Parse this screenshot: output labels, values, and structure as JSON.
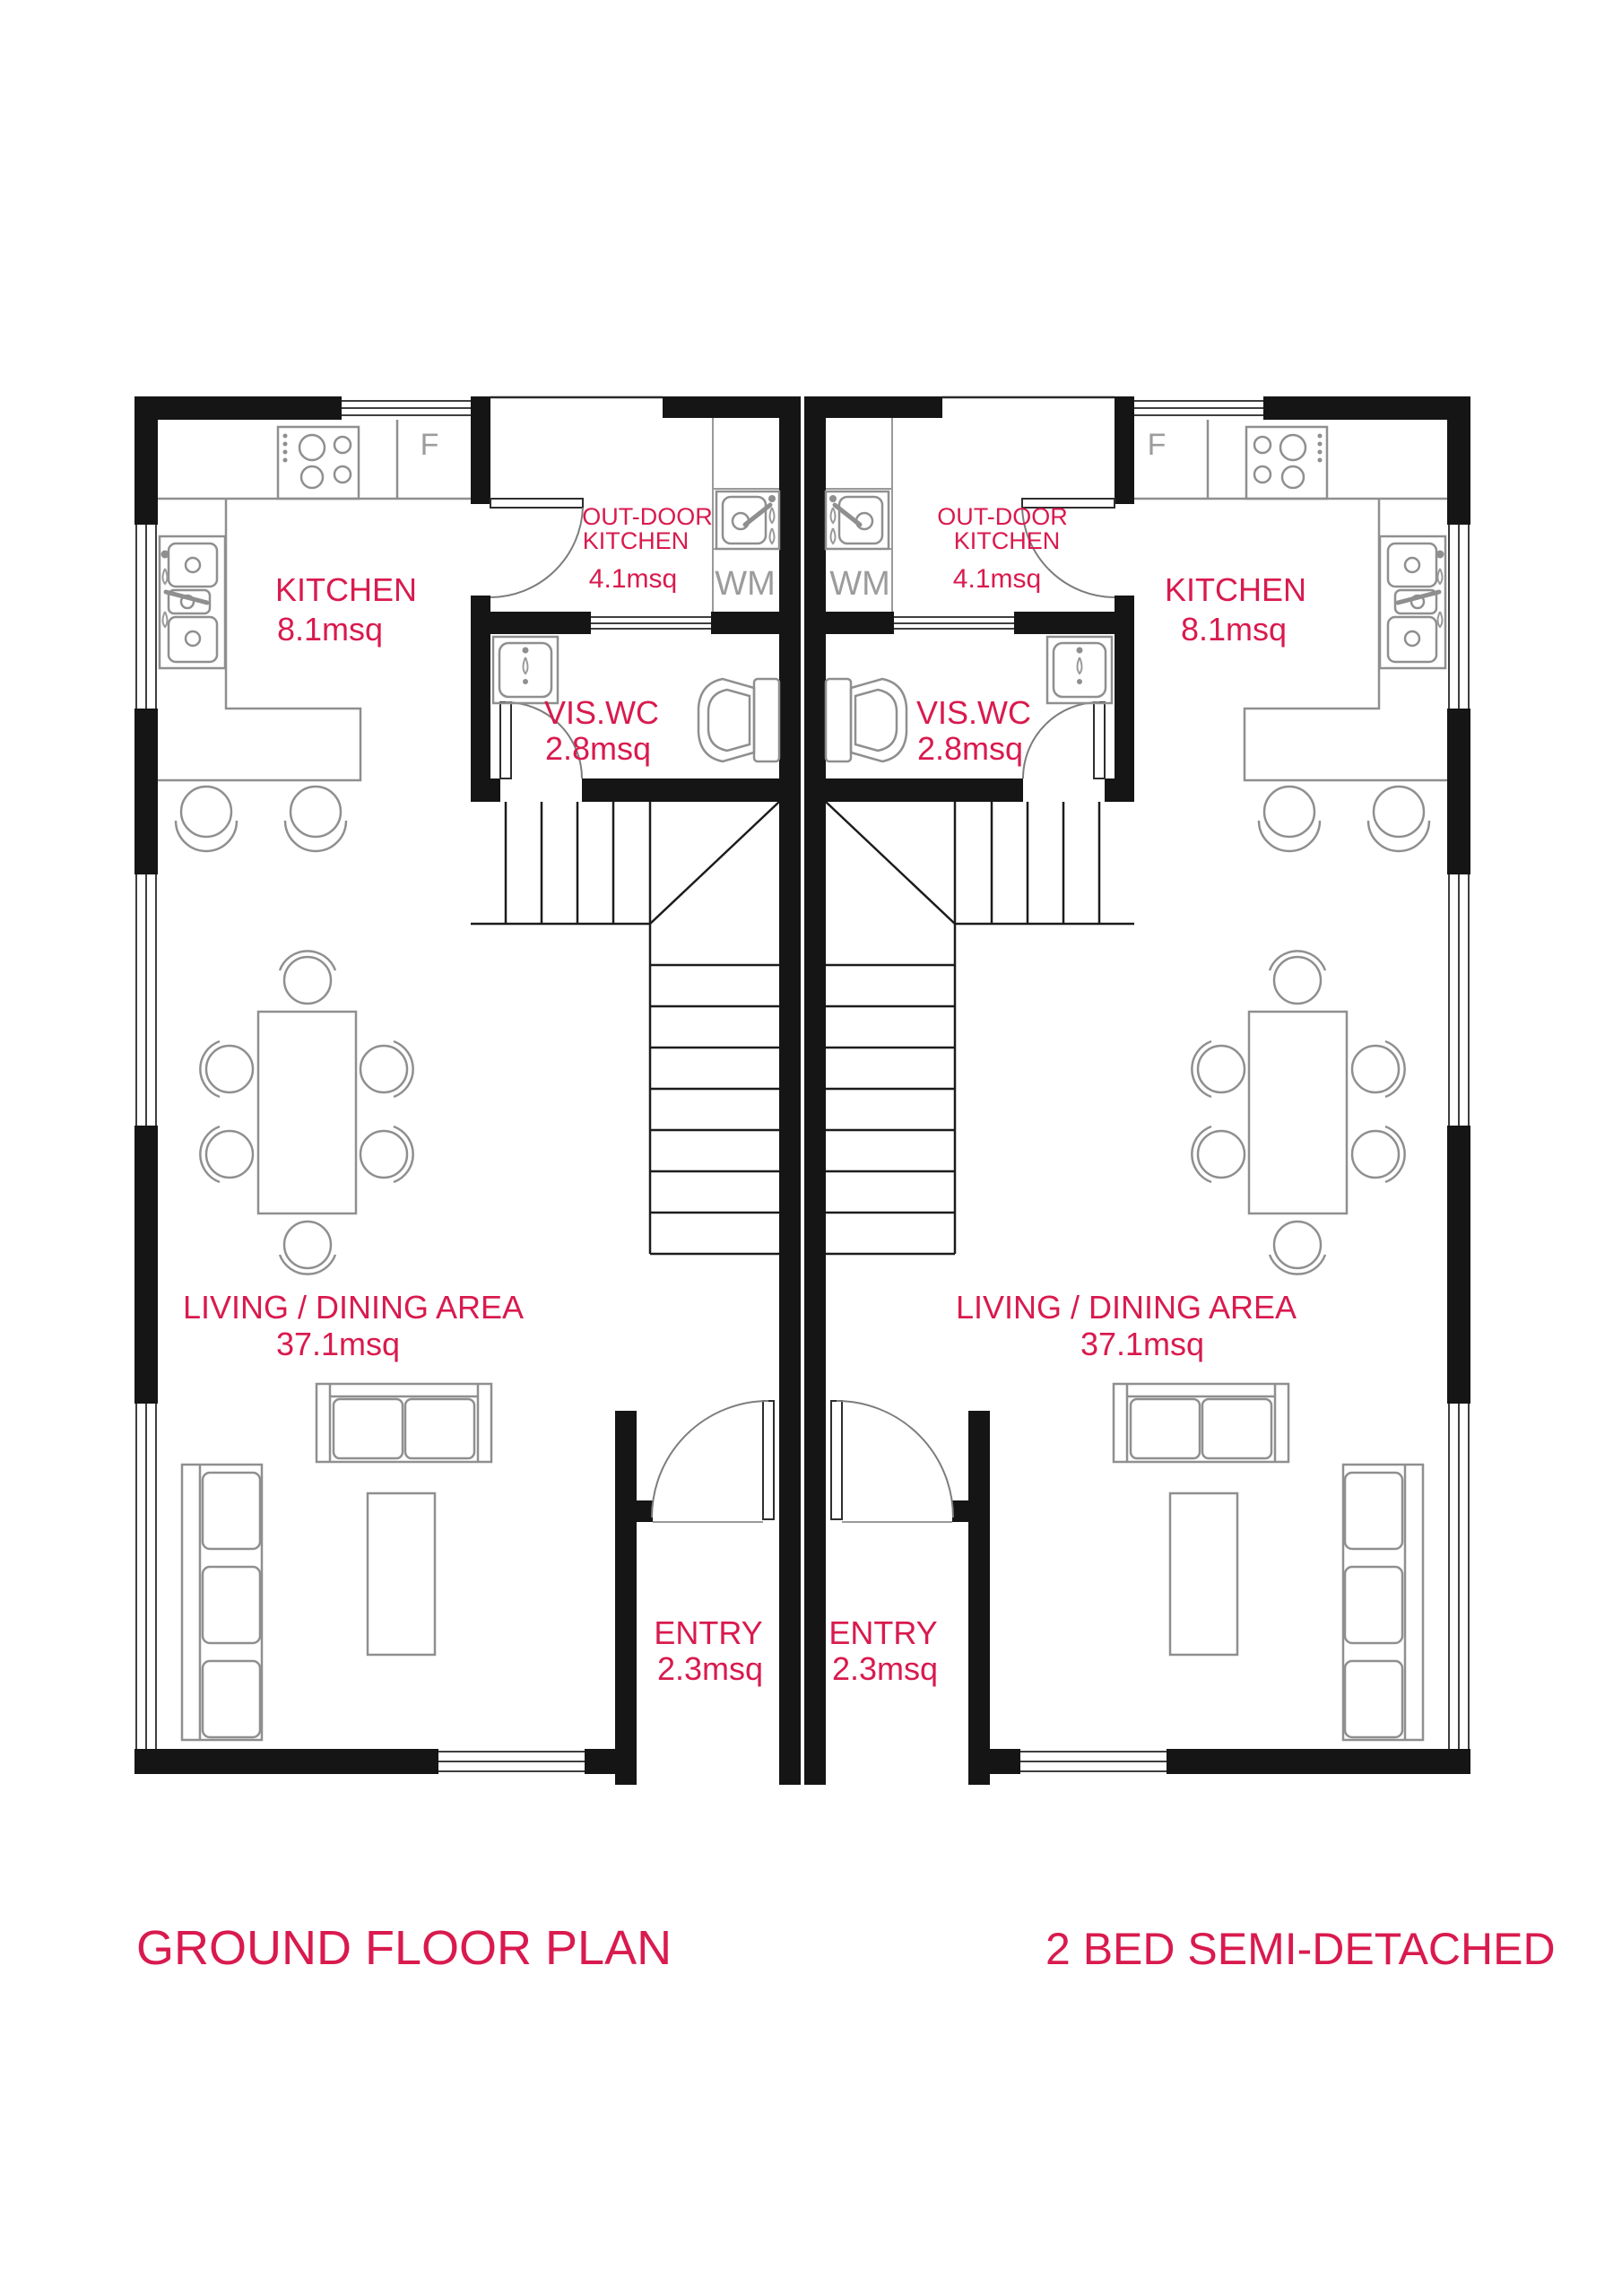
{
  "titles": {
    "left": "GROUND FLOOR PLAN",
    "right": "2 BED SEMI-DETACHED"
  },
  "rooms": {
    "kitchen": {
      "name": "KITCHEN",
      "area": "8.1msq"
    },
    "outdoor_kitchen": {
      "line1": "OUT-DOOR",
      "line2": "KITCHEN",
      "area": "4.1msq"
    },
    "vis_wc": {
      "name": "VIS.WC",
      "area": "2.8msq"
    },
    "living_dining": {
      "name": "LIVING / DINING AREA",
      "area": "37.1msq"
    },
    "entry": {
      "name": "ENTRY",
      "area": "2.3msq"
    }
  },
  "appliances": {
    "fridge": "F",
    "washing_machine": "WM"
  },
  "colors": {
    "label_pink": "#d91a4e",
    "wall_black": "#151515",
    "furniture_gray": "#8f8f8f",
    "appliance_text_gray": "#9c9c9c",
    "background": "#ffffff"
  }
}
